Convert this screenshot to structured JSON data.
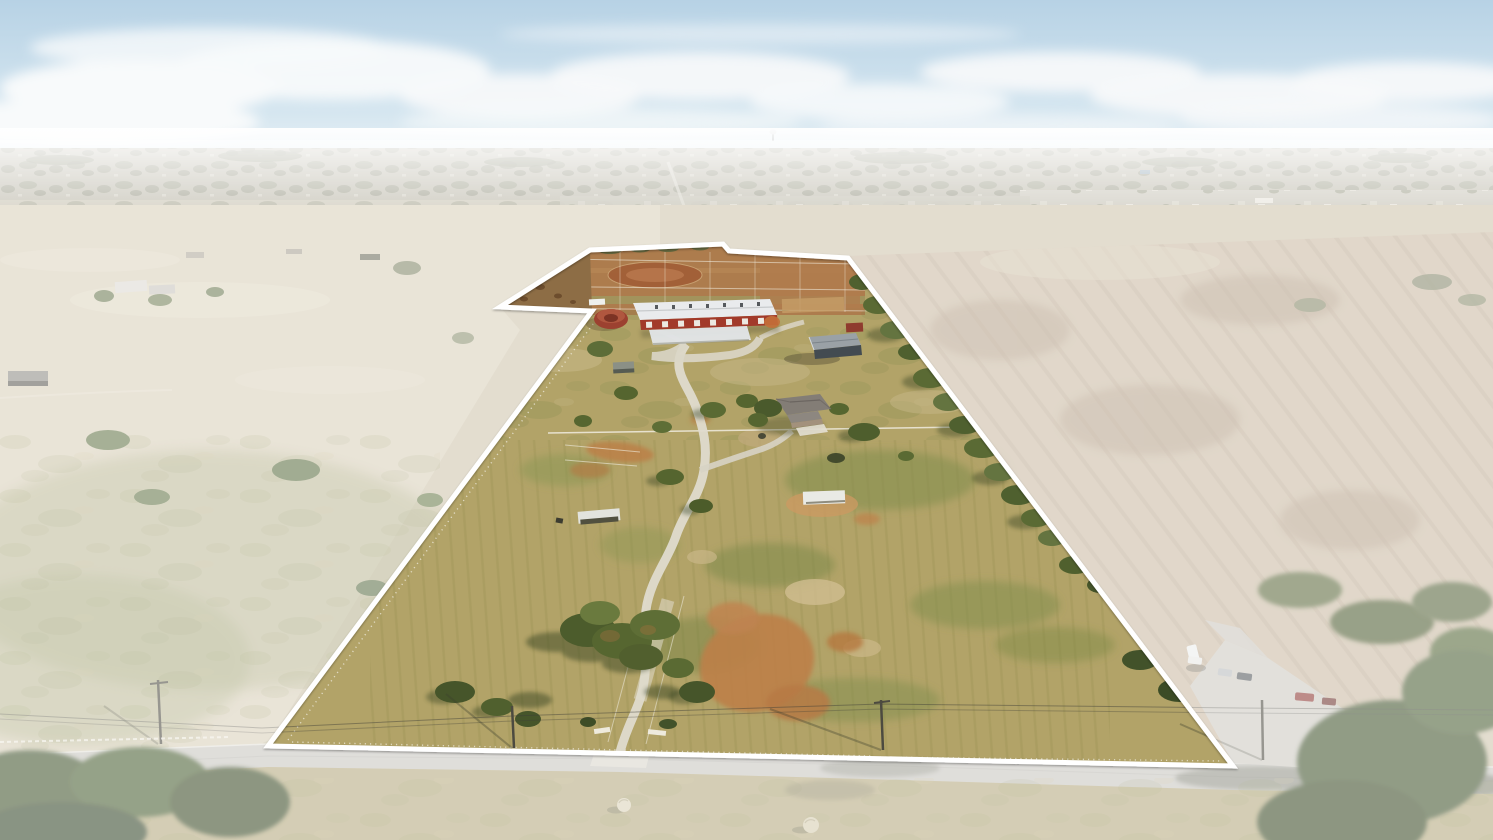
{
  "image": {
    "width": 1493,
    "height": 840,
    "kind": "aerial-drone-photograph"
  },
  "scene": {
    "description": "Oblique aerial drone photo of a rural equestrian ranch property for sale. A white polygon outline marks the lot boundary; land outside the boundary is desaturated with a white haze. Inside: a long white-roofed barn with red stall fronts, round pen, canopy, gray metal barn, brick house with gray roof, winding white concrete driveway from a road entrance, dirt paddocks and arena at the far end, dry autumn pastures with mowing rows, orange dirt patches, scattered trees, and white perimeter fencing. Outside: pale pastures on the left, a plowed striated field on the right, a suburban town stretching to a hazy horizon under a pale blue sky with a band of white clouds, a gray country road across the bottom with utility poles, hay bales, a neighboring parking area with cars, and large green trees in the corners.",
    "no_visible_text": true,
    "lighting": "low autumn sun from the right, long shadows cast down-left"
  },
  "boundary": {
    "points": "268,746 592,311 500,307 590,250 723,244 729,251 848,258 1233,766",
    "stroke_color": "#ffffff",
    "stroke_width": 5,
    "outside_haze_path": "M0,140 H1493 V840 H0 Z M268,746 L592,311 L500,307 L590,250 L723,244 L729,251 L848,258 L1233,766 Z",
    "outside_haze_color": "#ffffff",
    "outside_haze_opacity": 0.42
  },
  "palette": {
    "sky_top": "#b7d2e5",
    "sky_horizon": "#e2edf4",
    "cloud": "#f8fafb",
    "distant_band": "#b6b2a2",
    "town_speck": "#e6e2d8",
    "left_pasture": "#d9d0ba",
    "right_plowed_field": "#cbbba4",
    "plow_row": "#b09a82",
    "property_grass": "#b2a368",
    "green_patch": "#7f8d4a",
    "dirt_orange": "#bd8049",
    "paddock_dirt": "#ad7a4c",
    "barn_roof_white": "#e9ebed",
    "barn_red": "#a23a2a",
    "gray_barn_roof": "#9aa1a6",
    "house_roof": "#837d76",
    "road_gray": "#c8c6c0",
    "driveway_white": "#dfdbce",
    "tree_green_dark": "#42522a",
    "tree_green": "#55652f",
    "fence_white": "#f0ece0",
    "hay_bale": "#dbd3b8"
  },
  "objects": [
    {
      "name": "property-boundary-outline",
      "desc": "white polygon marking lot lines, notch at far left corner"
    },
    {
      "name": "main-barn",
      "desc": "long white gable roof, red walls with white stall doors, rooftop vents"
    },
    {
      "name": "front-canopy",
      "desc": "white awning in front of main barn"
    },
    {
      "name": "round-pen",
      "desc": "small round red-roofed structure left of barn"
    },
    {
      "name": "gray-metal-barn",
      "desc": "silver roof, dark slate side, right of barn yard"
    },
    {
      "name": "ranch-house",
      "desc": "hip-roofed brick house mid-property with backyard fence and trees"
    },
    {
      "name": "driveway",
      "desc": "white concrete lane winding from road entrance to barn, tree-lined mid-way"
    },
    {
      "name": "dirt-arena-and-paddocks",
      "desc": "orange dirt pens with white fencing at far end of property"
    },
    {
      "name": "loafing-sheds",
      "desc": "small white-roofed run-in sheds in pasture"
    },
    {
      "name": "hay-bales",
      "desc": "two round bales in roadside grass strip"
    },
    {
      "name": "country-road",
      "desc": "gray road across the bottom with utility poles and tree shadows"
    },
    {
      "name": "neighbor-parking",
      "desc": "gravel drive with several parked cars right of boundary"
    },
    {
      "name": "plowed-field",
      "desc": "striated brown field outside the right boundary"
    },
    {
      "name": "town-horizon",
      "desc": "hazy suburb with tree line, water tower silhouette, clouds"
    }
  ]
}
